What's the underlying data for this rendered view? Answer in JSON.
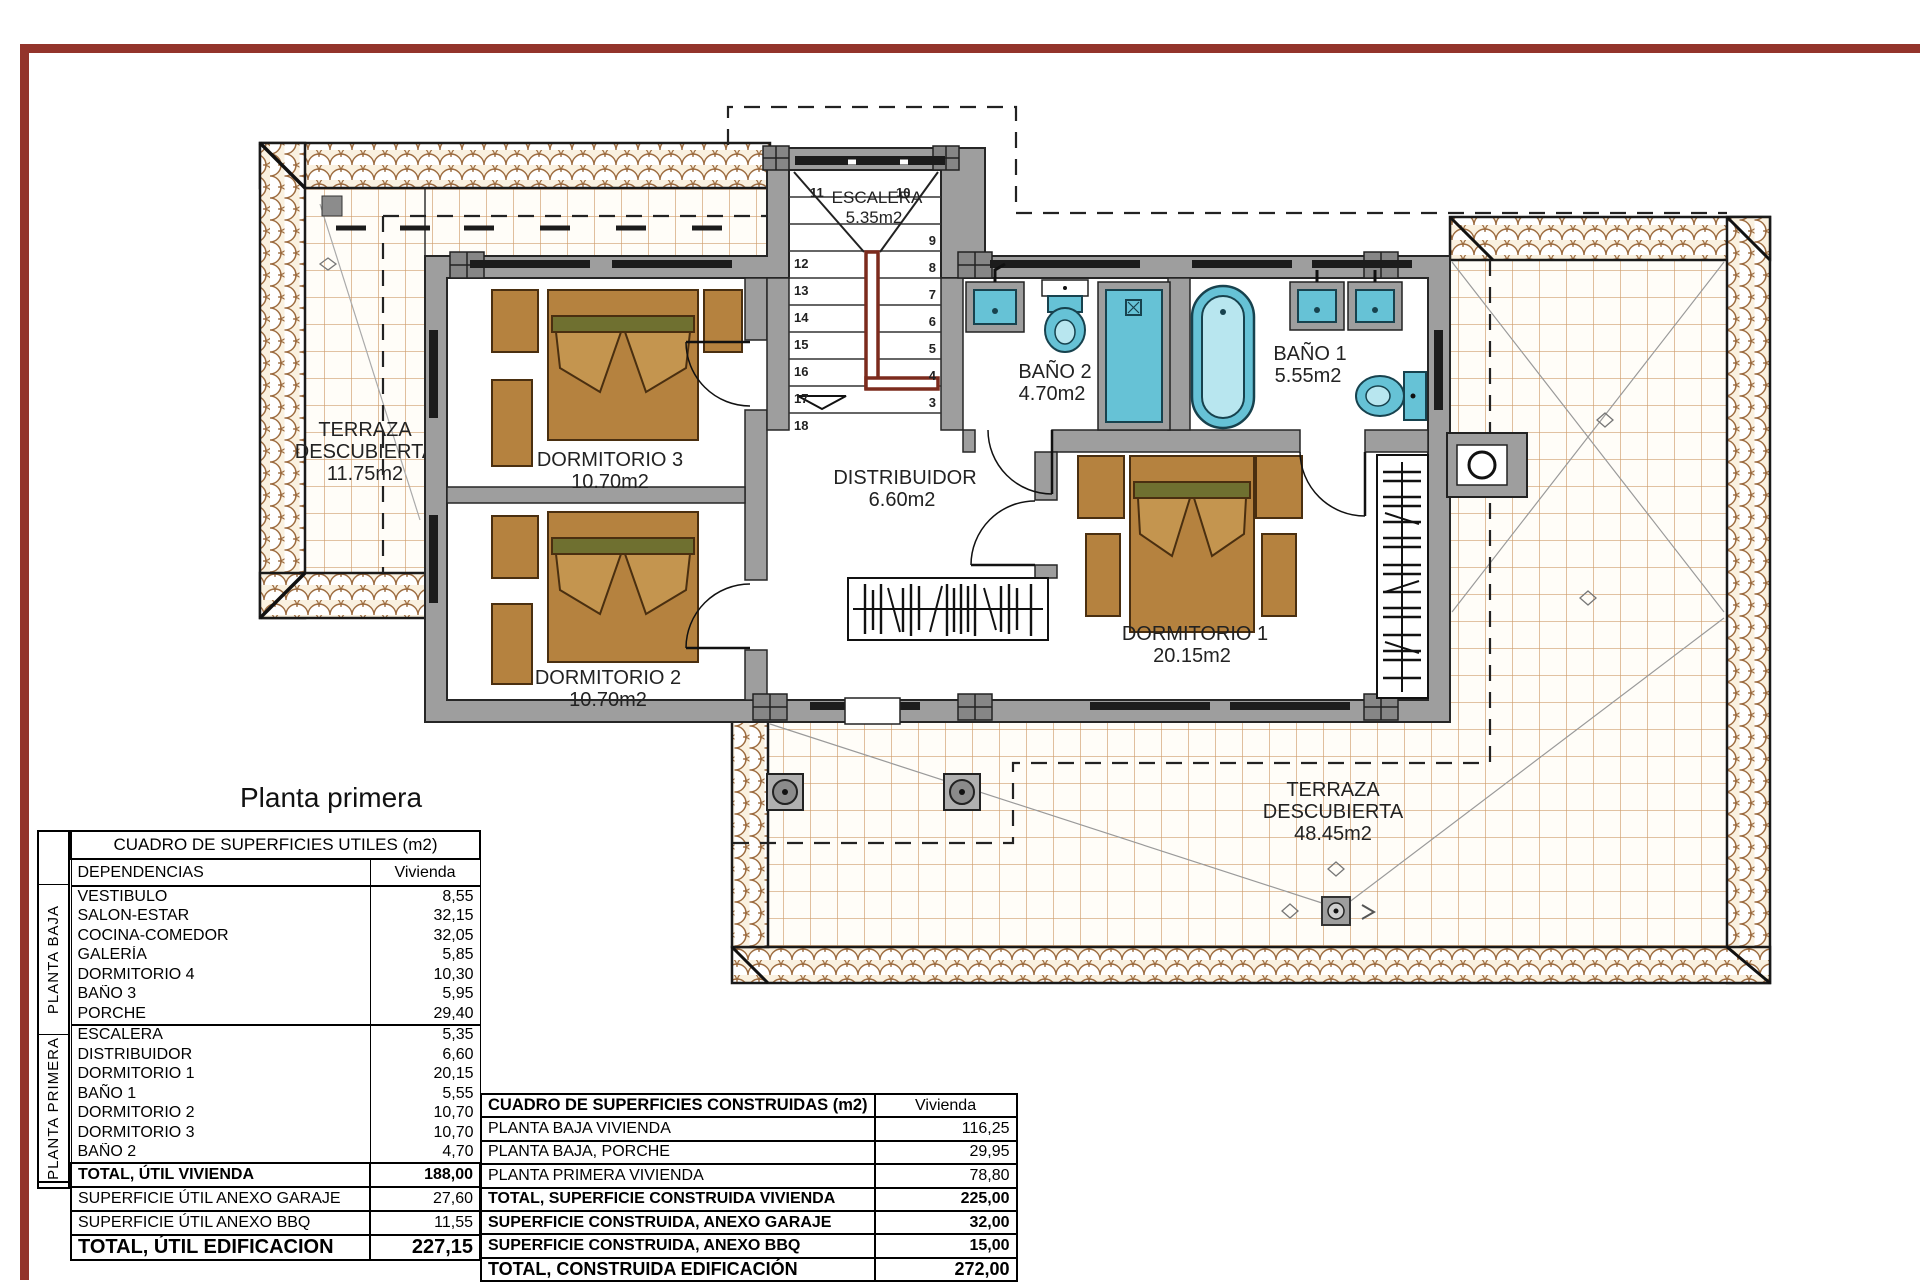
{
  "title": "Planta primera",
  "colors": {
    "frame-red": "#93342b",
    "wall-gray": "#9e9e9e",
    "furniture-brown": "#b5823f",
    "fixture-teal": "#66c2d6",
    "rail-red": "#7c2b1d",
    "tile-line": "#cf9e6e",
    "roof-stroke": "#9c6b3f"
  },
  "plan": {
    "rooms": {
      "terraza_izq": {
        "line1": "TERRAZA",
        "line2": "DESCUBIERTA",
        "line3": "11.75m2"
      },
      "dormitorio3": {
        "name": "DORMITORIO 3",
        "area": "10.70m2"
      },
      "dormitorio2": {
        "name": "DORMITORIO 2",
        "area": "10.70m2"
      },
      "dormitorio1": {
        "name": "DORMITORIO 1",
        "area": "20.15m2"
      },
      "escalera": {
        "name": "ESCALERA",
        "area": "5.35m2"
      },
      "distribuidor": {
        "name": "DISTRIBUIDOR",
        "area": "6.60m2"
      },
      "bano2": {
        "name": "BAÑO 2",
        "area": "4.70m2"
      },
      "bano1": {
        "name": "BAÑO 1",
        "area": "5.55m2"
      },
      "terraza_post": {
        "line1": "TERRAZA",
        "line2": "DESCUBIERTA",
        "line3": "48.45m2"
      }
    },
    "stairs": {
      "top": [
        "11",
        "10"
      ],
      "left": [
        "12",
        "13",
        "14",
        "15",
        "16",
        "17",
        "18"
      ],
      "right": [
        "9",
        "8",
        "7",
        "6",
        "5",
        "4",
        "3"
      ]
    }
  },
  "tables": {
    "utiles": {
      "title": "CUADRO DE SUPERFICIES UTILES (m2)",
      "col1": "DEPENDENCIAS",
      "col2": "Vivienda",
      "group1": "PLANTA BAJA",
      "group2": "PLANTA PRIMERA",
      "baja": [
        {
          "label": "VESTIBULO",
          "value": "8,55"
        },
        {
          "label": "SALON-ESTAR",
          "value": "32,15"
        },
        {
          "label": "COCINA-COMEDOR",
          "value": "32,05"
        },
        {
          "label": "GALERÍA",
          "value": "5,85"
        },
        {
          "label": "DORMITORIO 4",
          "value": "10,30"
        },
        {
          "label": "BAÑO 3",
          "value": "5,95"
        },
        {
          "label": "PORCHE",
          "value": "29,40"
        }
      ],
      "primera": [
        {
          "label": "ESCALERA",
          "value": "5,35"
        },
        {
          "label": "DISTRIBUIDOR",
          "value": "6,60"
        },
        {
          "label": "DORMITORIO 1",
          "value": "20,15"
        },
        {
          "label": "BAÑO 1",
          "value": "5,55"
        },
        {
          "label": "DORMITORIO 2",
          "value": "10,70"
        },
        {
          "label": "DORMITORIO 3",
          "value": "10,70"
        },
        {
          "label": "BAÑO 2",
          "value": "4,70"
        }
      ],
      "summary": [
        {
          "label": "TOTAL, ÚTIL VIVIENDA",
          "value": "188,00"
        },
        {
          "label": "SUPERFICIE ÚTIL ANEXO GARAJE",
          "value": "27,60"
        },
        {
          "label": "SUPERFICIE ÚTIL ANEXO BBQ",
          "value": "11,55"
        },
        {
          "label": "TOTAL, ÚTIL EDIFICACION",
          "value": "227,15"
        }
      ]
    },
    "construidas": {
      "title": "CUADRO DE SUPERFICIES CONSTRUIDAS (m2)",
      "col2": "Vivienda",
      "rows": [
        {
          "label": "PLANTA BAJA VIVIENDA",
          "value": "116,25"
        },
        {
          "label": "PLANTA BAJA, PORCHE",
          "value": "29,95"
        },
        {
          "label": "PLANTA PRIMERA VIVIENDA",
          "value": "78,80"
        },
        {
          "label": "TOTAL, SUPERFICIE CONSTRUIDA VIVIENDA",
          "value": "225,00"
        },
        {
          "label": "SUPERFICIE CONSTRUIDA, ANEXO GARAJE",
          "value": "32,00"
        },
        {
          "label": "SUPERFICIE CONSTRUIDA, ANEXO BBQ",
          "value": "15,00"
        },
        {
          "label": "TOTAL, CONSTRUIDA EDIFICACIÓN",
          "value": "272,00"
        }
      ]
    }
  }
}
